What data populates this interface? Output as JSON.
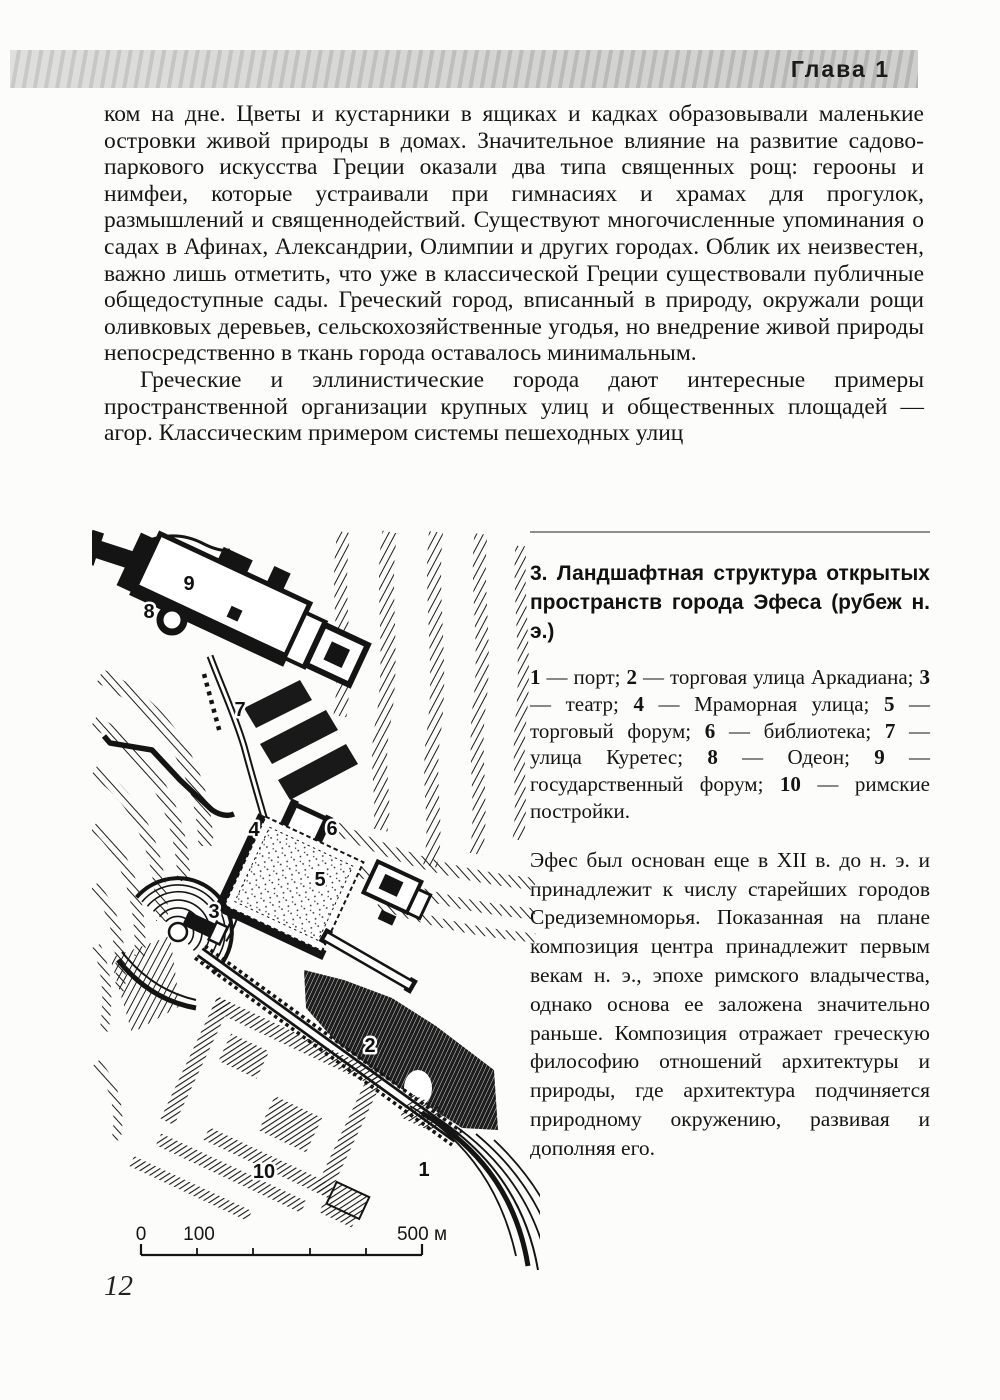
{
  "header": {
    "chapter": "Глава 1"
  },
  "body": {
    "paragraph1": "ком на дне. Цветы и кустарники в ящиках и кадках образовывали маленькие островки живой природы в домах. Значительное влияние на развитие садово-паркового искусства Греции оказали два типа священных рощ: герооны и нимфеи, которые устраивали при гимнасиях и храмах для прогулок, размышлений и священнодействий. Существуют многочисленные упоминания о садах в Афинах, Александрии, Олимпии и других городах. Облик их неизвестен, важно лишь отметить, что уже в классической Греции существовали публичные общедоступные сады. Греческий город, вписанный в природу, окружали рощи оливковых деревьев, сельскохозяйственные угодья, но внедрение живой природы непосредственно в ткань города оставалось минимальным.",
    "paragraph2": "Греческие и эллинистические города дают интересные примеры пространственной организации крупных улиц и общественных площадей — агор. Классическим примером системы пешеходных улиц"
  },
  "figure": {
    "caption_title": "3. Ландшафтная структура открытых пространств города Эфеса (рубеж н. э.)",
    "legend": {
      "items": [
        {
          "num": "1",
          "label": "— порт;"
        },
        {
          "num": "2",
          "label": "— торговая улица Аркадиана;"
        },
        {
          "num": "3",
          "label": "— театр;"
        },
        {
          "num": "4",
          "label": "— Мраморная улица;"
        },
        {
          "num": "5",
          "label": "— торговый форум;"
        },
        {
          "num": "6",
          "label": "— библиотека;"
        },
        {
          "num": "7",
          "label": "— улица Куретес;"
        },
        {
          "num": "8",
          "label": "— Одеон;"
        },
        {
          "num": "9",
          "label": "— государственный форум;"
        },
        {
          "num": "10",
          "label": "— римские постройки."
        }
      ]
    },
    "caption_body": "Эфес был основан еще в XII в. до н. э. и принадлежит к числу старейших городов Средиземноморья. Показанная на плане композиция центра принадлежит первым векам н. э., эпохе римского владычества, однако основа ее заложена значительно раньше. Композиция отражает греческую философию отношений архитектуры и природы, где архитектура подчиняется природному окружению, развивая и дополняя его.",
    "map": {
      "labels": [
        "1",
        "2",
        "3",
        "4",
        "5",
        "6",
        "7",
        "8",
        "9",
        "10"
      ],
      "scale": {
        "zero": "0",
        "hundred": "100",
        "end": "500 м"
      },
      "ink_color": "#141414"
    }
  },
  "footer": {
    "page_number": "12"
  }
}
